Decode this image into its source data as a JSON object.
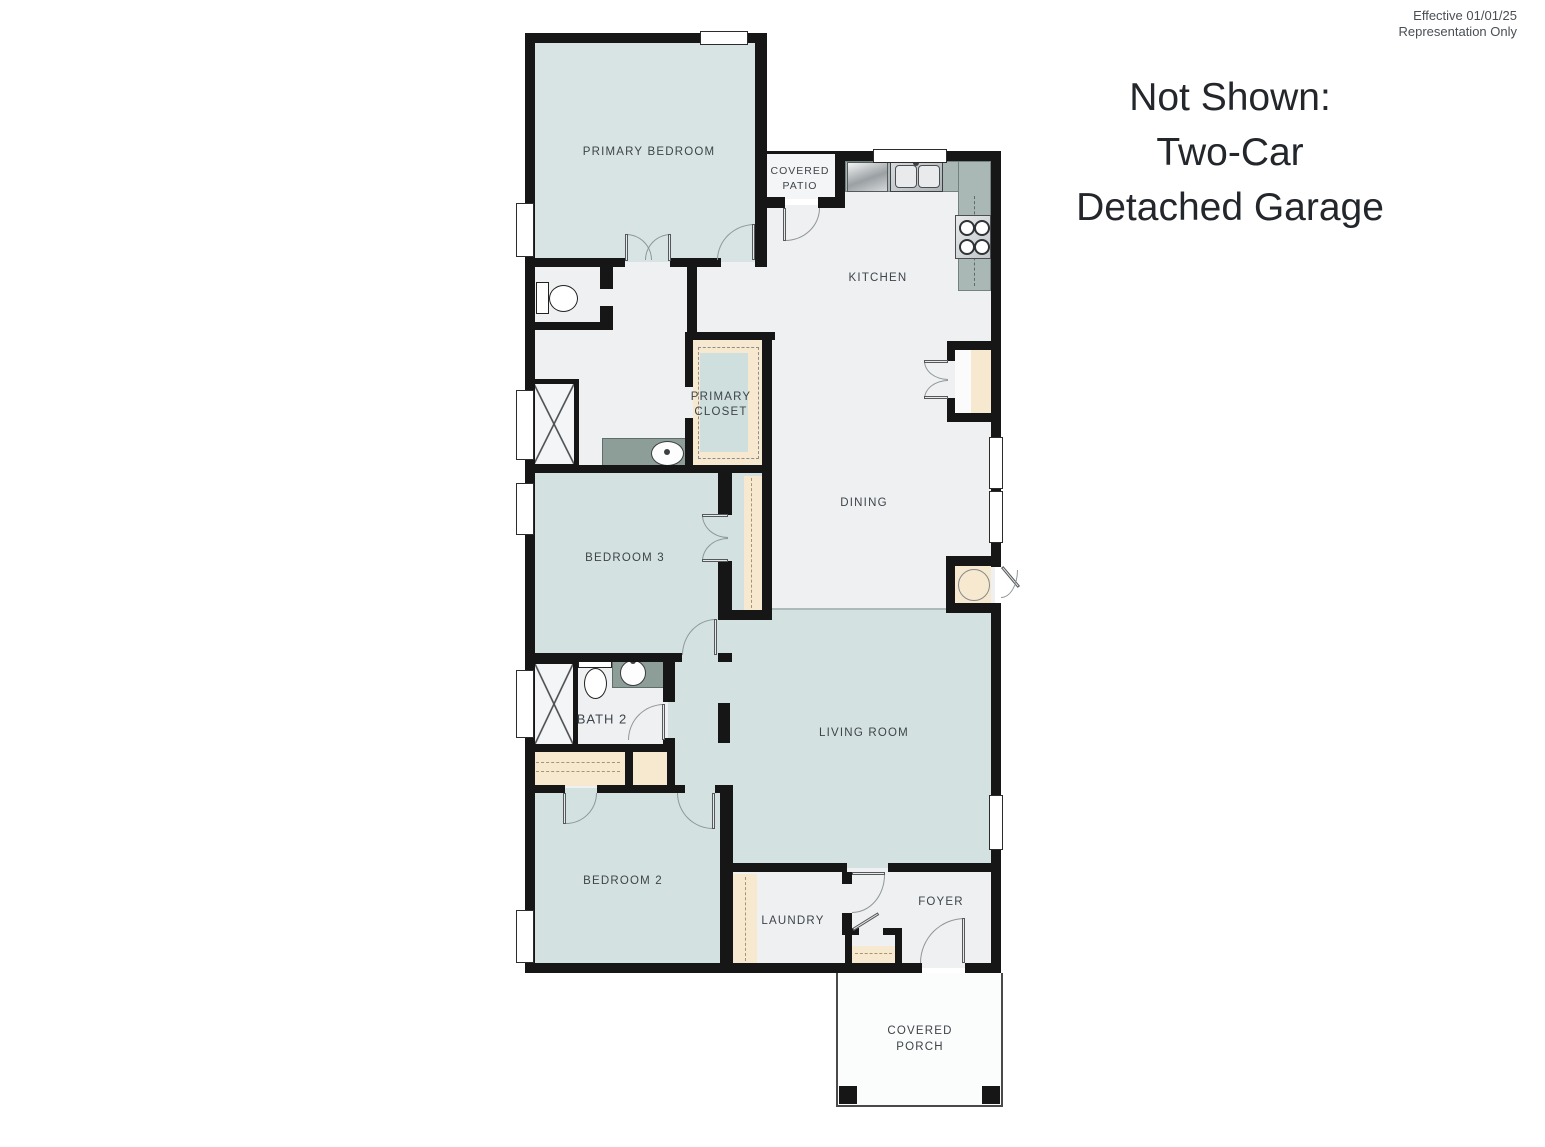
{
  "page": {
    "effective": [
      "Effective 01/01/25",
      "Representation Only"
    ],
    "not_shown": [
      "Not Shown:",
      "Two-Car",
      "Detached Garage"
    ]
  },
  "rooms": {
    "primary_bedroom": "PRIMARY BEDROOM",
    "covered_patio": [
      "COVERED",
      "PATIO"
    ],
    "kitchen": "KITCHEN",
    "primary_closet": [
      "PRIMARY",
      "CLOSET"
    ],
    "dining": "DINING",
    "bedroom_3": "BEDROOM 3",
    "bath_2": "BATH 2",
    "living_room": "LIVING ROOM",
    "bedroom_2": "BEDROOM 2",
    "laundry": "LAUNDRY",
    "foyer": "FOYER",
    "covered_porch": [
      "COVERED",
      "PORCH"
    ]
  },
  "fixtures": [
    "kitchen-sink",
    "dishwasher",
    "range-stove",
    "pantry",
    "water-heater",
    "toilet",
    "shower",
    "vanity-sink",
    "washer-dryer-shelf",
    "linen-shelf",
    "coat-closet"
  ],
  "colors": {
    "wall": "#161616",
    "room_teal": "#d3e2e1",
    "room_white": "#eef0f2",
    "closet_cream": "#f6e9cf",
    "counter_sage": "#a9b8b4",
    "vanity_sage": "#8d9e99",
    "door_arc": "#8f9699",
    "label_text": "#3e4449"
  }
}
